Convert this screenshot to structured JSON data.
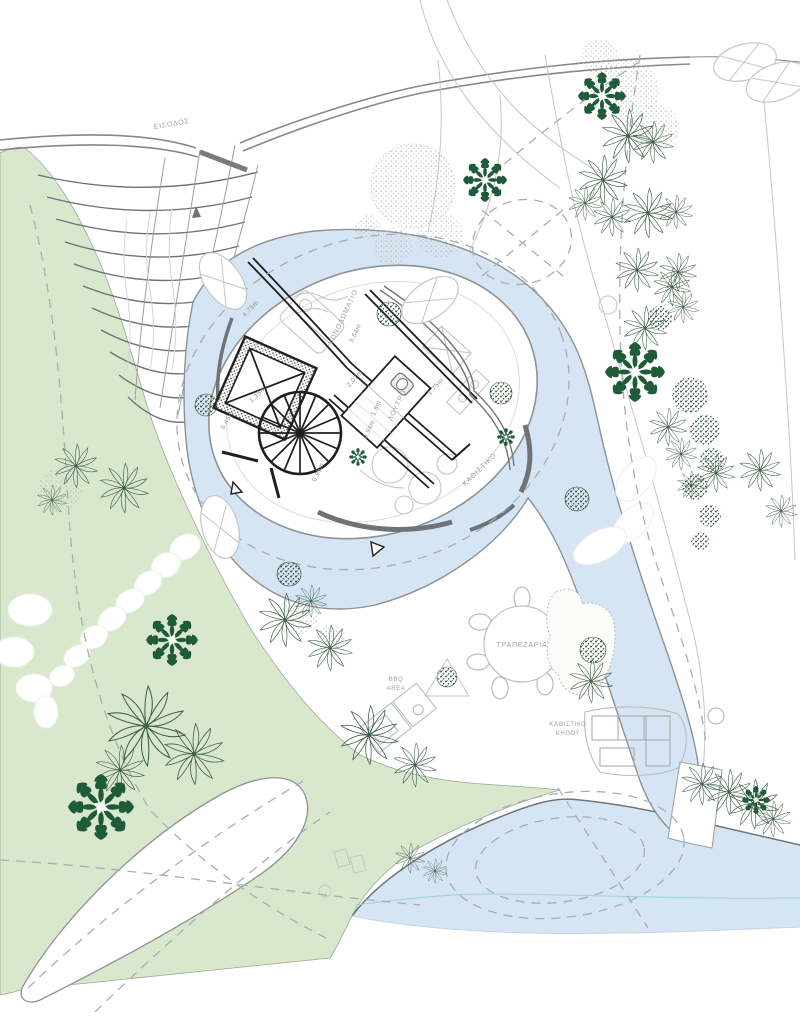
{
  "plan": {
    "labels": {
      "entrance": "ΕΙΣΟΔΟΣ",
      "bedroom": "ΥΠΝΟΔΩΜΑΤΙΟ",
      "bathroom": "ΛΟΥΤΡΟ",
      "living": "ΚΑΘΙΣΤΙΚΟ",
      "dining": "ΤΡΑΠΕΖΑΡΙΑ",
      "bbq_line1": "BBQ",
      "bbq_line2": "AREA",
      "garden_living_line1": "ΚΑΘΙΣΤΙΚΟ",
      "garden_living_line2": "ΚΗΠΟΥ"
    },
    "dimensions": {
      "d475": "4.75m",
      "d364": "3.64m",
      "d207": "2.07m",
      "d175": "1.75m",
      "d16": "1.6m",
      "d094": "0.94m",
      "d645": "6.45m",
      "d135": "1.35m",
      "d095": "0.95m"
    }
  },
  "colors": {
    "lawn": "#d9e8cc",
    "water": "#d5e5f4",
    "water-line": "#9ed3d3",
    "palm-dark": "#1e5b38",
    "palm-line": "#41604d",
    "wall": "#1f1f1f",
    "line-gray": "#8f9498",
    "line-light": "#c3c6c8",
    "dashed": "#a9aeb2",
    "deck": "#6e7377",
    "label": "#9ba0a3",
    "dim": "#8d9296",
    "stone-edge": "#b9bdbf"
  }
}
